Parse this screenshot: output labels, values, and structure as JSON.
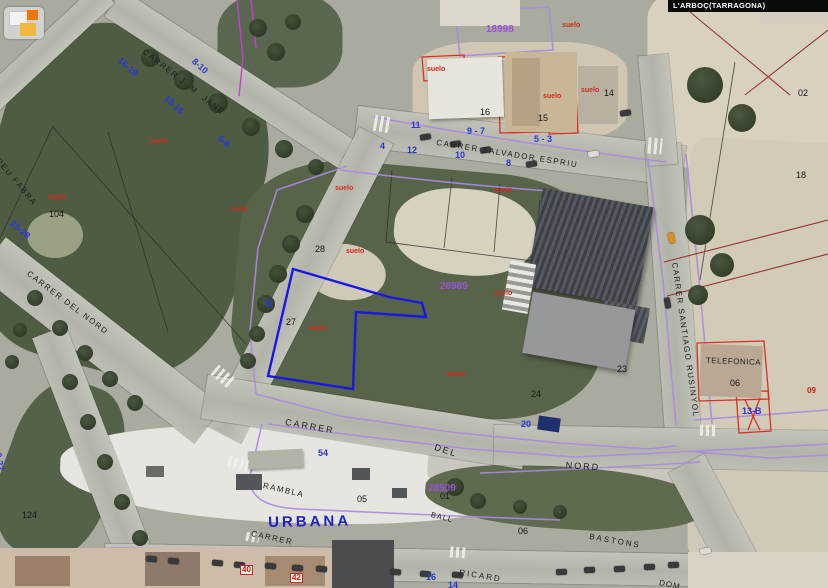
{
  "app": {
    "location_bar": "L'ARBOÇ(TARRAGONA)",
    "logo_name": "catastro-logo"
  },
  "colors": {
    "cadastral": "#a98be2",
    "magenta": "#c43fcf",
    "selected_parcel": "#1717e8",
    "red_outline": "#d93025",
    "dark_red": "#963232",
    "black_line": "#2a2a2a",
    "house_number": "#2a35d8",
    "parcel_id": "#9a52d8",
    "suelo": "#d42a1a",
    "street_text": "#1c1c1c",
    "urban_blue": "#2020c8"
  },
  "map": {
    "urban_label": {
      "t": "URBANA",
      "x": 268,
      "y": 515,
      "rot": -1
    },
    "street_labels": [
      {
        "t": "CARRER  SALVADOR  ESPRIU",
        "x": 437,
        "y": 139,
        "rot": 9,
        "fs": 8,
        "ls": 1.5
      },
      {
        "t": "CARRER  SANTIAGO  RUSINYOL",
        "x": 678,
        "y": 262,
        "rot": 82,
        "fs": 8,
        "ls": 1.5
      },
      {
        "t": "CARRER  J. M. JANE",
        "x": 146,
        "y": 48,
        "rot": 38,
        "fs": 8,
        "ls": 1.5
      },
      {
        "t": "POMPEU  FABRA",
        "x": -14,
        "y": 140,
        "rot": 50,
        "fs": 8,
        "ls": 1.5
      },
      {
        "t": "CARRER  DEL  NORD",
        "x": 30,
        "y": 270,
        "rot": 37,
        "fs": 8,
        "ls": 1.5
      },
      {
        "t": "CARRER",
        "x": 286,
        "y": 418,
        "rot": 10,
        "fs": 9,
        "ls": 2
      },
      {
        "t": "DEL",
        "x": 436,
        "y": 443,
        "rot": 18,
        "fs": 9,
        "ls": 2
      },
      {
        "t": "NORD",
        "x": 566,
        "y": 461,
        "rot": 4,
        "fs": 9,
        "ls": 2
      },
      {
        "t": "RAMBLA",
        "x": 264,
        "y": 482,
        "rot": 13,
        "fs": 8,
        "ls": 1.5
      },
      {
        "t": "CARRER",
        "x": 252,
        "y": 530,
        "rot": 12,
        "fs": 8,
        "ls": 1.5
      },
      {
        "t": "RICARD",
        "x": 460,
        "y": 569,
        "rot": 9,
        "fs": 8,
        "ls": 2
      },
      {
        "t": "BASTONS",
        "x": 590,
        "y": 533,
        "rot": 10,
        "fs": 8,
        "ls": 2
      },
      {
        "t": "TELEFONICA",
        "x": 706,
        "y": 357,
        "rot": 2,
        "fs": 8,
        "ls": 0.5
      },
      {
        "t": "BALL",
        "x": 432,
        "y": 511,
        "rot": 14,
        "fs": 7.5,
        "ls": 1
      },
      {
        "t": "DOM",
        "x": 660,
        "y": 579,
        "rot": 12,
        "fs": 8,
        "ls": 1
      }
    ],
    "house_numbers": [
      {
        "t": "11",
        "x": 411,
        "y": 121
      },
      {
        "t": "9 - 7",
        "x": 467,
        "y": 127
      },
      {
        "t": "5 - 3",
        "x": 534,
        "y": 135
      },
      {
        "t": "4",
        "x": 380,
        "y": 142
      },
      {
        "t": "12",
        "x": 407,
        "y": 146
      },
      {
        "t": "10",
        "x": 455,
        "y": 151
      },
      {
        "t": "8",
        "x": 506,
        "y": 159
      },
      {
        "t": "16-18",
        "x": 122,
        "y": 56,
        "rot": 42
      },
      {
        "t": "8-10",
        "x": 196,
        "y": 57,
        "rot": 42
      },
      {
        "t": "10-16",
        "x": 168,
        "y": 94,
        "rot": 42
      },
      {
        "t": "6-8",
        "x": 222,
        "y": 134,
        "rot": 42
      },
      {
        "t": "25-28",
        "x": 14,
        "y": 219,
        "rot": 40
      },
      {
        "t": "30",
        "x": 271,
        "y": 297,
        "rot": 76
      },
      {
        "t": "0-22",
        "x": 2,
        "y": 452,
        "rot": 80
      },
      {
        "t": "54",
        "x": 318,
        "y": 449
      },
      {
        "t": "20",
        "x": 521,
        "y": 420
      },
      {
        "t": "13-B",
        "x": 742,
        "y": 407
      },
      {
        "t": "16",
        "x": 426,
        "y": 573
      },
      {
        "t": "14",
        "x": 448,
        "y": 581
      }
    ],
    "parcel_numbers": [
      {
        "t": "16",
        "x": 480,
        "y": 108
      },
      {
        "t": "15",
        "x": 538,
        "y": 114
      },
      {
        "t": "14",
        "x": 604,
        "y": 89
      },
      {
        "t": "28",
        "x": 315,
        "y": 245
      },
      {
        "t": "27",
        "x": 286,
        "y": 318
      },
      {
        "t": "23",
        "x": 617,
        "y": 365
      },
      {
        "t": "24",
        "x": 531,
        "y": 390
      },
      {
        "t": "104",
        "x": 49,
        "y": 210
      },
      {
        "t": "02",
        "x": 798,
        "y": 89
      },
      {
        "t": "18",
        "x": 796,
        "y": 171
      },
      {
        "t": "06",
        "x": 730,
        "y": 379
      },
      {
        "t": "06",
        "x": 518,
        "y": 527
      },
      {
        "t": "05",
        "x": 357,
        "y": 495
      },
      {
        "t": "01",
        "x": 440,
        "y": 492
      },
      {
        "t": "124",
        "x": 22,
        "y": 511
      }
    ],
    "parcel_ids": [
      {
        "t": "18998",
        "x": 486,
        "y": 25
      },
      {
        "t": "28989",
        "x": 440,
        "y": 282
      },
      {
        "t": "28509",
        "x": 428,
        "y": 484
      }
    ],
    "suelo_labels": [
      {
        "t": "suelo",
        "x": 562,
        "y": 22
      },
      {
        "t": "suelo",
        "x": 427,
        "y": 66
      },
      {
        "t": "suelo",
        "x": 543,
        "y": 93
      },
      {
        "t": "suelo",
        "x": 581,
        "y": 87
      },
      {
        "t": "suelo",
        "x": 335,
        "y": 185
      },
      {
        "t": "suelo",
        "x": 494,
        "y": 187
      },
      {
        "t": "suelo",
        "x": 230,
        "y": 206
      },
      {
        "t": "suelo",
        "x": 346,
        "y": 248
      },
      {
        "t": "suelo",
        "x": 308,
        "y": 325
      },
      {
        "t": "suelo",
        "x": 494,
        "y": 290
      },
      {
        "t": "suelo",
        "x": 447,
        "y": 371
      },
      {
        "t": "suelo",
        "x": 48,
        "y": 194
      },
      {
        "t": "suelo",
        "x": 149,
        "y": 138
      }
    ],
    "red_numbers": [
      {
        "t": "40",
        "x": 240,
        "y": 565
      },
      {
        "t": "42",
        "x": 290,
        "y": 573
      },
      {
        "t": "09",
        "x": 806,
        "y": 387,
        "plain": true
      }
    ]
  },
  "scene": {
    "roads": [
      {
        "cx": 520,
        "cy": 146,
        "len": 330,
        "w": 40,
        "ang": 7
      },
      {
        "cx": 235,
        "cy": 82,
        "len": 290,
        "w": 32,
        "ang": 33
      },
      {
        "cx": 45,
        "cy": 50,
        "len": 165,
        "w": 26,
        "ang": 137
      },
      {
        "cx": 300,
        "cy": 285,
        "len": 335,
        "w": 38,
        "ang": 117
      },
      {
        "cx": 100,
        "cy": 340,
        "len": 275,
        "w": 46,
        "ang": 38
      },
      {
        "cx": 100,
        "cy": 465,
        "len": 285,
        "w": 36,
        "ang": 69
      },
      {
        "cx": 673,
        "cy": 290,
        "len": 292,
        "w": 36,
        "ang": 86
      },
      {
        "cx": 658,
        "cy": 110,
        "len": 110,
        "w": 30,
        "ang": 85
      },
      {
        "cx": 365,
        "cy": 422,
        "len": 325,
        "w": 44,
        "ang": 9
      },
      {
        "cx": 664,
        "cy": 448,
        "len": 340,
        "w": 40,
        "ang": 1
      },
      {
        "cx": 405,
        "cy": 565,
        "len": 600,
        "w": 32,
        "ang": 1
      },
      {
        "cx": 712,
        "cy": 512,
        "len": 110,
        "w": 40,
        "ang": 62
      }
    ],
    "patches": [
      {
        "cx": 120,
        "cy": 200,
        "w": 270,
        "h": 340,
        "ang": 15,
        "c": "#4e5c44",
        "br": "35%"
      },
      {
        "cx": 420,
        "cy": 290,
        "w": 370,
        "h": 245,
        "ang": 5,
        "c": "#57644a",
        "br": "30%"
      },
      {
        "cx": 280,
        "cy": 40,
        "w": 125,
        "h": 95,
        "ang": 0,
        "c": "#5a6750",
        "br": "40%"
      },
      {
        "cx": 60,
        "cy": 470,
        "w": 110,
        "h": 180,
        "ang": 20,
        "c": "#55624a",
        "br": "40%"
      },
      {
        "cx": 745,
        "cy": 80,
        "w": 195,
        "h": 175,
        "ang": 0,
        "c": "#d8d1c0",
        "br": "15%"
      },
      {
        "cx": 760,
        "cy": 290,
        "w": 155,
        "h": 300,
        "ang": 3,
        "c": "#d2cbb8",
        "br": "10%"
      },
      {
        "cx": 520,
        "cy": 92,
        "w": 215,
        "h": 100,
        "ang": 0,
        "c": "#cfc7b4",
        "br": "30%"
      },
      {
        "cx": 760,
        "cy": 505,
        "w": 145,
        "h": 125,
        "ang": 0,
        "c": "#cfc9ba",
        "br": "20%"
      },
      {
        "cx": 465,
        "cy": 232,
        "w": 142,
        "h": 86,
        "ang": 5,
        "c": "#d7d1c0",
        "br": "45%"
      },
      {
        "cx": 345,
        "cy": 272,
        "w": 82,
        "h": 56,
        "ang": 8,
        "c": "#cfc9b8",
        "br": "50%"
      },
      {
        "cx": 55,
        "cy": 235,
        "w": 56,
        "h": 46,
        "ang": 0,
        "c": "#9aa184",
        "br": "50%"
      },
      {
        "cx": 300,
        "cy": 475,
        "w": 480,
        "h": 96,
        "ang": 2,
        "c": "#e7e5df",
        "br": "45% 55% 50% 50%"
      },
      {
        "cx": 560,
        "cy": 472,
        "w": 265,
        "h": 72,
        "ang": 3,
        "c": "#c8c6bd",
        "br": "40%"
      },
      {
        "cx": 565,
        "cy": 498,
        "w": 280,
        "h": 62,
        "ang": 4,
        "c": "#5f6b4e",
        "br": "45%"
      }
    ],
    "trees": [
      [
        150,
        58,
        9
      ],
      [
        184,
        80,
        10
      ],
      [
        218,
        103,
        10
      ],
      [
        251,
        127,
        9
      ],
      [
        284,
        149,
        9
      ],
      [
        316,
        167,
        8
      ],
      [
        305,
        214,
        9
      ],
      [
        291,
        244,
        9
      ],
      [
        278,
        274,
        9
      ],
      [
        266,
        304,
        9
      ],
      [
        257,
        334,
        8
      ],
      [
        248,
        361,
        8
      ],
      [
        35,
        298,
        8
      ],
      [
        60,
        328,
        8
      ],
      [
        85,
        353,
        8
      ],
      [
        110,
        379,
        8
      ],
      [
        135,
        403,
        8
      ],
      [
        70,
        382,
        8
      ],
      [
        88,
        422,
        8
      ],
      [
        105,
        462,
        8
      ],
      [
        122,
        502,
        8
      ],
      [
        140,
        538,
        8
      ],
      [
        705,
        85,
        18
      ],
      [
        742,
        118,
        14
      ],
      [
        700,
        230,
        15
      ],
      [
        722,
        265,
        12
      ],
      [
        698,
        295,
        10
      ],
      [
        258,
        28,
        9
      ],
      [
        276,
        52,
        9
      ],
      [
        293,
        22,
        8
      ],
      [
        455,
        487,
        9
      ],
      [
        478,
        501,
        8
      ],
      [
        520,
        507,
        7
      ],
      [
        560,
        512,
        7
      ],
      [
        12,
        362,
        7
      ],
      [
        20,
        330,
        7
      ]
    ],
    "cars": [
      [
        420,
        134,
        -9,
        "dark"
      ],
      [
        450,
        141,
        -9,
        "dark"
      ],
      [
        480,
        147,
        -9,
        "dark"
      ],
      [
        526,
        161,
        -9,
        "dark"
      ],
      [
        588,
        151,
        -9,
        "light"
      ],
      [
        620,
        110,
        -9,
        "dark"
      ],
      [
        666,
        235,
        78,
        "amber"
      ],
      [
        662,
        300,
        80,
        "dark"
      ],
      [
        146,
        556,
        5,
        "dark"
      ],
      [
        168,
        558,
        5,
        "dark"
      ],
      [
        212,
        560,
        5,
        "dark"
      ],
      [
        234,
        562,
        5,
        "dark"
      ],
      [
        265,
        563,
        5,
        "dark"
      ],
      [
        292,
        565,
        5,
        "dark"
      ],
      [
        316,
        566,
        5,
        "dark"
      ],
      [
        390,
        569,
        5,
        "dark"
      ],
      [
        420,
        571,
        5,
        "dark"
      ],
      [
        452,
        572,
        5,
        "dark"
      ],
      [
        556,
        569,
        -3,
        "dark"
      ],
      [
        584,
        567,
        -3,
        "dark"
      ],
      [
        614,
        566,
        -3,
        "dark"
      ],
      [
        644,
        564,
        -3,
        "dark"
      ],
      [
        668,
        562,
        -3,
        "dark"
      ],
      [
        700,
        548,
        -10,
        "light"
      ]
    ],
    "crosswalks": [
      [
        374,
        116,
        16,
        16,
        10
      ],
      [
        648,
        138,
        14,
        16,
        5
      ],
      [
        212,
        370,
        22,
        13,
        40
      ],
      [
        228,
        458,
        20,
        11,
        15
      ],
      [
        700,
        425,
        16,
        11,
        3
      ],
      [
        450,
        547,
        16,
        11,
        5
      ],
      [
        246,
        533,
        13,
        9,
        12
      ]
    ]
  }
}
